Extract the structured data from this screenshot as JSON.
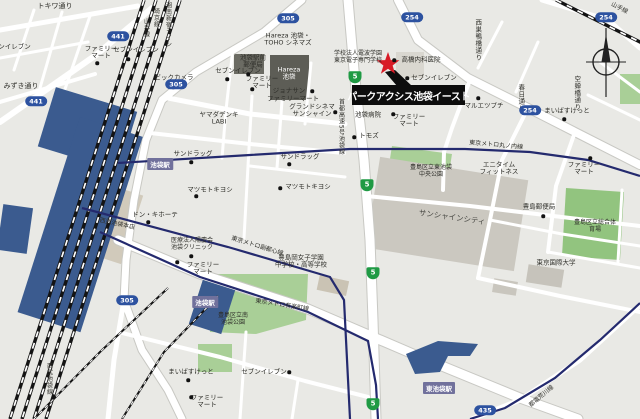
{
  "marker": {
    "name": "パークアクシス池袋イースト"
  },
  "colors": {
    "background": "#e9e9e5",
    "road": "#ffffff",
    "park_green": "#a9cf97",
    "station_blue": "#3b5b8f",
    "metro_navy": "#242a6e",
    "badge_blue": "#2d52a0",
    "badge_green": "#1f9a44",
    "star_red": "#d81b26",
    "marker_black": "#0d0d0d",
    "station_label_purple": "#71719c"
  },
  "route_badges": [
    {
      "n": "route-441-badge-1",
      "kind": "blue",
      "num": "441",
      "x": 118,
      "y": 36
    },
    {
      "n": "route-441-badge-2",
      "kind": "blue",
      "num": "441",
      "x": 36,
      "y": 101
    },
    {
      "n": "route-305-badge-1",
      "kind": "blue",
      "num": "305",
      "x": 288,
      "y": 18
    },
    {
      "n": "route-305-badge-2",
      "kind": "blue",
      "num": "305",
      "x": 176,
      "y": 84
    },
    {
      "n": "route-305-badge-3",
      "kind": "blue",
      "num": "305",
      "x": 127,
      "y": 300
    },
    {
      "n": "route-254-badge-1",
      "kind": "blue",
      "num": "254",
      "x": 412,
      "y": 17
    },
    {
      "n": "route-254-badge-2",
      "kind": "blue",
      "num": "254",
      "x": 530,
      "y": 110
    },
    {
      "n": "route-254-badge-3",
      "kind": "blue",
      "num": "254",
      "x": 606,
      "y": 17
    },
    {
      "n": "route-435-badge",
      "kind": "blue",
      "num": "435",
      "x": 485,
      "y": 410
    },
    {
      "n": "expressway-5-badge-1",
      "kind": "green",
      "num": "5",
      "x": 355,
      "y": 77
    },
    {
      "n": "expressway-5-badge-2",
      "kind": "green",
      "num": "5",
      "x": 367,
      "y": 185
    },
    {
      "n": "expressway-5-badge-3",
      "kind": "green",
      "num": "5",
      "x": 373,
      "y": 273
    },
    {
      "n": "expressway-5-badge-4",
      "kind": "green",
      "num": "5",
      "x": 373,
      "y": 404
    }
  ],
  "station_labels": [
    {
      "n": "station-label-ikebukuro-1",
      "t": "池袋駅",
      "x": 160,
      "y": 164
    },
    {
      "n": "station-label-ikebukuro-2",
      "t": "池袋駅",
      "x": 205,
      "y": 302
    },
    {
      "n": "station-label-higashi-ikebukuro",
      "t": "東池袋駅",
      "x": 439,
      "y": 388
    }
  ],
  "labels": [
    {
      "n": "street-label-tokiwa-dori",
      "t": "トキワ通り",
      "x": 55,
      "y": 6,
      "fs": 7
    },
    {
      "n": "poi-seven-eleven-edge",
      "t": "セブンイレブン",
      "x": 8,
      "y": 47
    },
    {
      "n": "poi-seven-eleven-1",
      "t": "セブンイレブン",
      "x": 136,
      "y": 50,
      "dot": [
        128,
        59
      ]
    },
    {
      "n": "poi-family-mart-1",
      "t": "ファミリー\nマート",
      "x": 101,
      "y": 53,
      "dot": [
        97,
        63
      ]
    },
    {
      "n": "street-label-mizuki-dori",
      "t": "みずき通り",
      "x": 21,
      "y": 86,
      "fs": 7
    },
    {
      "n": "poi-bic-camera",
      "t": "ビックカメラ",
      "x": 174,
      "y": 78,
      "dot": [
        173,
        87
      ]
    },
    {
      "n": "poi-yamada-denki-labi",
      "t": "ヤマダデンキ\nLABI",
      "x": 219,
      "y": 119
    },
    {
      "n": "poi-hareza-toho-cinemas",
      "t": "Hareza 池袋・\nTOHO シネマズ",
      "x": 288,
      "y": 40
    },
    {
      "n": "building-label-hareza-ikebukuro",
      "t": "Hareza\n池袋",
      "x": 289,
      "y": 74,
      "c": "#ffffff"
    },
    {
      "n": "poi-ikebukuro-ekimae-post-office",
      "t": "池袋駅前\n郵便局",
      "x": 253,
      "y": 62,
      "dot": [
        248,
        74
      ]
    },
    {
      "n": "poi-seven-eleven-2",
      "t": "セブンイレブン",
      "x": 238,
      "y": 71,
      "dot": [
        227,
        79
      ]
    },
    {
      "n": "poi-family-mart-2",
      "t": "ファミリー\nマート",
      "x": 262,
      "y": 83,
      "dot": [
        252,
        89
      ]
    },
    {
      "n": "poi-tokyo-denshi-college",
      "t": "学校法人電波学園\n東京電子専門学校",
      "x": 358,
      "y": 58,
      "fs": 6
    },
    {
      "n": "poi-takahashi-naika-clinic",
      "t": "高橋内科医院",
      "x": 421,
      "y": 60,
      "dot": [
        394,
        60
      ]
    },
    {
      "n": "poi-seven-eleven-3",
      "t": "セブンイレブン",
      "x": 434,
      "y": 78,
      "dot": [
        407,
        78
      ]
    },
    {
      "n": "poi-ikebukuro-hospital",
      "t": "池袋病院",
      "x": 368,
      "y": 115
    },
    {
      "n": "poi-family-mart-3",
      "t": "ファミリー\nマート",
      "x": 409,
      "y": 121,
      "dot": [
        393,
        114
      ]
    },
    {
      "n": "poi-maruetsu-petit",
      "t": "マルエツプチ",
      "x": 484,
      "y": 106,
      "dot": [
        478,
        98
      ]
    },
    {
      "n": "poi-my-basket-1",
      "t": "まいばすけっと",
      "x": 567,
      "y": 111,
      "dot": [
        564,
        119
      ]
    },
    {
      "n": "poi-jonathan",
      "t": "ジョナサン",
      "x": 289,
      "y": 91,
      "dot": [
        312,
        91
      ]
    },
    {
      "n": "poi-family-mart-4",
      "t": "ファミリーマート",
      "x": 293,
      "y": 99
    },
    {
      "n": "poi-grand-cinema-sunshine",
      "t": "グランドシネマ\nサンシャイン",
      "x": 312,
      "y": 111,
      "dot": [
        335,
        112
      ]
    },
    {
      "n": "poi-sundrug-1",
      "t": "サンドラッグ",
      "x": 193,
      "y": 154,
      "dot": [
        191,
        162
      ]
    },
    {
      "n": "poi-sundrug-2",
      "t": "サンドラッグ",
      "x": 300,
      "y": 157,
      "dot": [
        289,
        164
      ]
    },
    {
      "n": "poi-matsumoto-kiyoshi-1",
      "t": "マツモトキヨシ",
      "x": 210,
      "y": 190,
      "dot": [
        196,
        196
      ]
    },
    {
      "n": "poi-matsumoto-kiyoshi-2",
      "t": "マツモトキヨシ",
      "x": 308,
      "y": 187,
      "dot": [
        280,
        188
      ]
    },
    {
      "n": "poi-don-quijote",
      "t": "ドン・キホーテ",
      "x": 155,
      "y": 215,
      "dot": [
        148,
        222
      ]
    },
    {
      "n": "building-label-seibu-ikebukuro",
      "t": "西武池袋本店",
      "x": 117,
      "y": 225,
      "fs": 6,
      "rot": 12
    },
    {
      "n": "poi-ikebukuro-clinic",
      "t": "医療法人陽慶会\n池袋クリニック",
      "x": 192,
      "y": 245,
      "fs": 6,
      "dot": [
        191,
        256
      ]
    },
    {
      "n": "poi-family-mart-5",
      "t": "ファミリー\nマート",
      "x": 203,
      "y": 269,
      "dot": [
        177,
        262
      ]
    },
    {
      "n": "poi-tomods",
      "t": "トモズ",
      "x": 369,
      "y": 136,
      "dot": [
        354,
        137
      ]
    },
    {
      "n": "metro-label-marunouchi-line",
      "t": "東京メトロ丸ノ内線",
      "x": 496,
      "y": 146,
      "fs": 6,
      "rot": 5
    },
    {
      "n": "poi-anytime-fitness",
      "t": "エニタイム\nフィットネス",
      "x": 499,
      "y": 169
    },
    {
      "n": "poi-family-mart-6",
      "t": "ファミリー\nマート",
      "x": 584,
      "y": 169,
      "dot": [
        590,
        158
      ]
    },
    {
      "n": "park-label-higashi-ikebukuro-chuo",
      "t": "豊島区立東池袋\n中央公園",
      "x": 431,
      "y": 172,
      "fs": 6
    },
    {
      "n": "metro-label-fukutoshin-line",
      "t": "東京メトロ副都心線",
      "x": 257,
      "y": 247,
      "fs": 6,
      "rot": 17
    },
    {
      "n": "metro-label-yurakucho-line",
      "t": "東京メトロ有楽町線",
      "x": 282,
      "y": 306,
      "fs": 6,
      "rot": 9
    },
    {
      "n": "poi-toshimagaoka-joshi-gakuen",
      "t": "豊島岡女子学園\n中学校・高等学校",
      "x": 301,
      "y": 262
    },
    {
      "n": "building-label-sunshine-city",
      "t": "サンシャインシティ",
      "x": 452,
      "y": 218,
      "fs": 7.5,
      "rot": 8,
      "c": "#4a4a45"
    },
    {
      "n": "poi-toshima-post-office",
      "t": "豊島郵便局",
      "x": 539,
      "y": 207,
      "dot": [
        543,
        216
      ]
    },
    {
      "n": "park-label-toshima-sogo-taiikujo",
      "t": "豊島区立総合体育場",
      "x": 595,
      "y": 227,
      "fs": 6
    },
    {
      "n": "poi-tokyo-international-university",
      "t": "東京国際大学",
      "x": 556,
      "y": 263
    },
    {
      "n": "street-label-utsusemibashi-dori",
      "t": "空蝉橋通り",
      "x": 576,
      "y": 93,
      "vert": true
    },
    {
      "n": "street-label-nishisugamobashi-dori",
      "t": "西巣鴨橋通り",
      "x": 477,
      "y": 40,
      "vert": true
    },
    {
      "n": "street-label-kasuga-dori",
      "t": "春日通り",
      "x": 520,
      "y": 98,
      "vert": true
    },
    {
      "n": "expressway-label-shuto-no5",
      "t": "首都高速5号池袋線",
      "x": 340,
      "y": 127,
      "fs": 6,
      "vert": true
    },
    {
      "n": "rail-label-yamanote-line-1",
      "t": "山手線",
      "x": 145,
      "y": 28,
      "fs": 6,
      "vert": true
    },
    {
      "n": "rail-label-saikyo-line",
      "t": "埼京線",
      "x": 155,
      "y": 18,
      "fs": 6,
      "vert": true
    },
    {
      "n": "rail-label-shonan-shinjuku-line",
      "t": "湘南新宿ライン",
      "x": 167,
      "y": 25,
      "fs": 6,
      "vert": true
    },
    {
      "n": "rail-label-yamanote-line-2",
      "t": "山手線",
      "x": 619,
      "y": 9,
      "fs": 6,
      "rot": 28
    },
    {
      "n": "park-label-minami-ikebukuro",
      "t": "豊島区立南\n池袋公園",
      "x": 233,
      "y": 320,
      "fs": 6
    },
    {
      "n": "poi-seven-eleven-4",
      "t": "セブンイレブン",
      "x": 264,
      "y": 372,
      "dot": [
        289,
        372
      ]
    },
    {
      "n": "poi-my-basket-2",
      "t": "まいばすけっと",
      "x": 191,
      "y": 372,
      "dot": [
        188,
        380
      ]
    },
    {
      "n": "poi-family-mart-7",
      "t": "ファミリー\nマート",
      "x": 207,
      "y": 402,
      "dot": [
        191,
        397
      ]
    },
    {
      "n": "rail-label-seibu-ikebukuro-line",
      "t": "西武池袋線",
      "x": 48,
      "y": 379,
      "fs": 6,
      "vert": true
    },
    {
      "n": "rail-label-toden-arakawa-line",
      "t": "都電荒川線",
      "x": 542,
      "y": 397,
      "fs": 6,
      "rot": -40
    }
  ]
}
